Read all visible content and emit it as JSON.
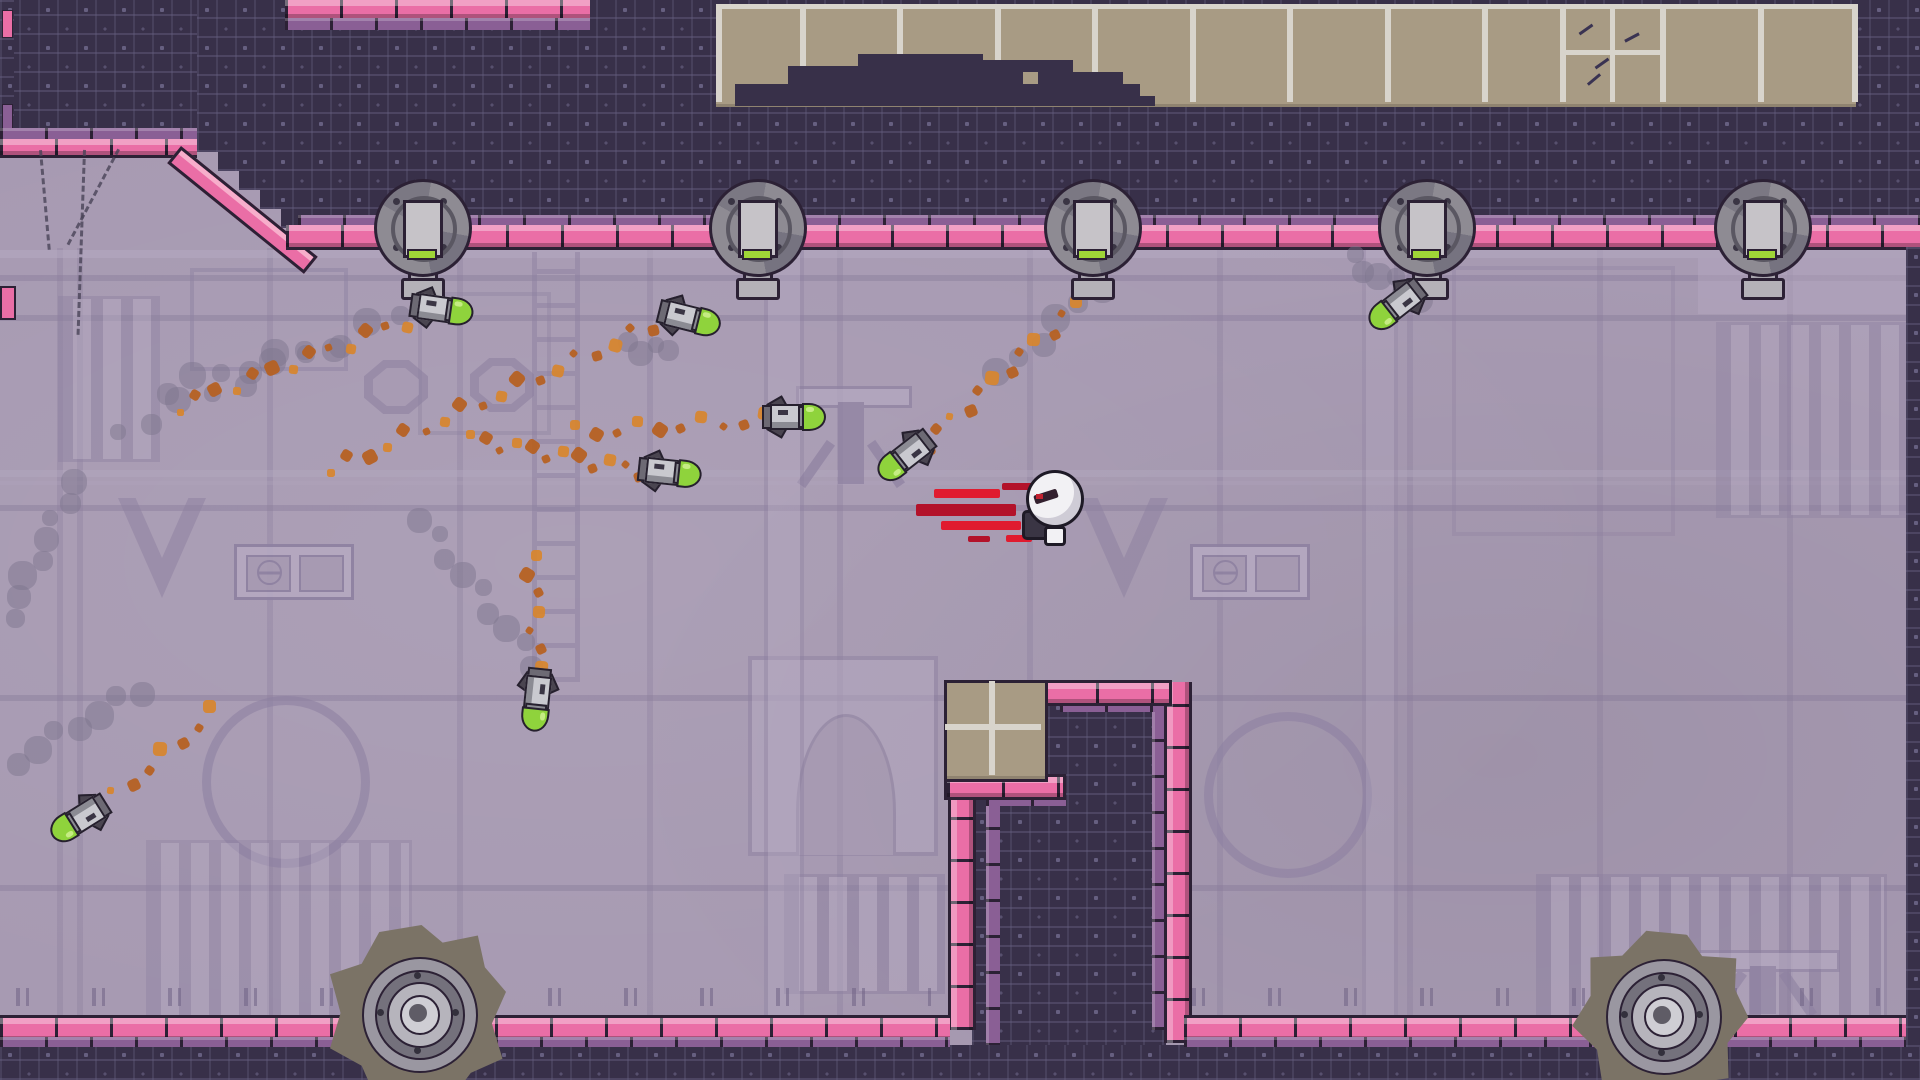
{
  "meta": {
    "scene_type": "pixel-platformer level",
    "visible_text": "none"
  },
  "palette": {
    "dark_tile": "#383049",
    "dark_outline": "#2c2135",
    "circuit_line": "#665f80",
    "wall_lavender": "#a79ab2",
    "wall_light": "#b5a9c1",
    "wall_shadow": "#8e81a1",
    "wall_line": "#7d7092",
    "brick_pink": "#ea6ea6",
    "brick_pink_highlight": "#f7aecb",
    "brick_purple_cap": "#8a5f95",
    "ceiling_tan": "#a89b84",
    "ceiling_divider": "#d8d4cc",
    "missile_green": "#8fd33c",
    "missile_steel": "#c9c9cf",
    "missile_steel_dark": "#8b8b93",
    "turret_gray": "#8e8b93",
    "turret_light": "#c6c3c8",
    "turret_green_light": "#9fd637",
    "gear_blade": "#7b7366",
    "gear_ring": "#9a97a1",
    "gear_core": "#cfced4",
    "trail_orange": "#b65f1e",
    "trail_orange_bright": "#d8862c",
    "smoke_gray": "#7d7590",
    "player_white": "#f2f1f4",
    "player_trail_red": "#e01b2f",
    "player_trail_red_dark": "#b3122a"
  },
  "scene": {
    "turrets": {
      "centers_x": [
        420,
        755,
        1090,
        1424,
        1760
      ],
      "center_y": 225
    },
    "missiles": [
      {
        "x": 440,
        "y": 307,
        "rot": 8
      },
      {
        "x": 688,
        "y": 316,
        "rot": 14
      },
      {
        "x": 792,
        "y": 415,
        "rot": 0
      },
      {
        "x": 908,
        "y": 457,
        "rot": 142
      },
      {
        "x": 668,
        "y": 470,
        "rot": 6
      },
      {
        "x": 539,
        "y": 698,
        "rot": 96
      },
      {
        "x": 82,
        "y": 820,
        "rot": 148
      },
      {
        "x": 1399,
        "y": 306,
        "rot": 142
      }
    ],
    "player": {
      "x": 1022,
      "y": 468
    },
    "red_streaks": [
      {
        "x": 934,
        "y": 489,
        "w": 66,
        "h": 9
      },
      {
        "x": 916,
        "y": 504,
        "w": 100,
        "h": 12
      },
      {
        "x": 941,
        "y": 521,
        "w": 80,
        "h": 9
      },
      {
        "x": 1002,
        "y": 483,
        "w": 34,
        "h": 7
      },
      {
        "x": 1006,
        "y": 535,
        "w": 26,
        "h": 7
      },
      {
        "x": 968,
        "y": 536,
        "w": 22,
        "h": 6
      }
    ],
    "gears": [
      {
        "x": 418,
        "y": 1013,
        "r": 88,
        "rot": 0
      },
      {
        "x": 1662,
        "y": 1015,
        "r": 84,
        "rot": 15
      }
    ],
    "trails": [
      {
        "t": "smoke",
        "x1": 118,
        "y1": 432,
        "x2": 432,
        "y2": 302,
        "n": 11
      },
      {
        "t": "smoke",
        "x1": 10,
        "y1": 616,
        "x2": 74,
        "y2": 482,
        "n": 8
      },
      {
        "t": "smoke",
        "x1": 166,
        "y1": 388,
        "x2": 332,
        "y2": 344,
        "n": 7
      },
      {
        "t": "smoke",
        "x1": 420,
        "y1": 520,
        "x2": 536,
        "y2": 664,
        "n": 9
      },
      {
        "t": "smoke",
        "x1": 1000,
        "y1": 376,
        "x2": 1118,
        "y2": 268,
        "n": 7
      },
      {
        "t": "smoke",
        "x1": 1352,
        "y1": 260,
        "x2": 1420,
        "y2": 298,
        "n": 6
      },
      {
        "t": "smoke",
        "x1": 628,
        "y1": 344,
        "x2": 668,
        "y2": 352,
        "n": 4
      },
      {
        "t": "smoke",
        "x1": 16,
        "y1": 760,
        "x2": 140,
        "y2": 690,
        "n": 7
      },
      {
        "t": "orange",
        "x1": 178,
        "y1": 406,
        "x2": 424,
        "y2": 314,
        "n": 14
      },
      {
        "t": "orange",
        "x1": 330,
        "y1": 470,
        "x2": 652,
        "y2": 326,
        "n": 18
      },
      {
        "t": "orange",
        "x1": 470,
        "y1": 438,
        "x2": 640,
        "y2": 470,
        "n": 12
      },
      {
        "t": "orange",
        "x1": 575,
        "y1": 432,
        "x2": 765,
        "y2": 420,
        "n": 10
      },
      {
        "t": "orange",
        "x1": 533,
        "y1": 556,
        "x2": 539,
        "y2": 686,
        "n": 8
      },
      {
        "t": "orange",
        "x1": 1078,
        "y1": 304,
        "x2": 924,
        "y2": 444,
        "n": 12
      },
      {
        "t": "orange",
        "x1": 214,
        "y1": 712,
        "x2": 98,
        "y2": 810,
        "n": 8
      },
      {
        "t": "orange",
        "x1": 1426,
        "y1": 270,
        "x2": 1402,
        "y2": 300,
        "n": 4
      }
    ],
    "chains": [
      {
        "x": 42,
        "y": 150,
        "len": 100,
        "rot": 85
      },
      {
        "x": 120,
        "y": 150,
        "len": 108,
        "rot": 118
      },
      {
        "x": 86,
        "y": 150,
        "len": 185,
        "rot": 92
      }
    ],
    "ceiling": {
      "dividers_x": [
        716,
        800,
        897,
        995,
        1092,
        1190,
        1287,
        1385,
        1482,
        1560,
        1660,
        1758,
        1852
      ],
      "quad_lines": [
        {
          "x": 1610,
          "y": 6,
          "w": 5,
          "h": 96
        },
        {
          "x": 1565,
          "y": 50,
          "w": 95,
          "h": 5
        }
      ],
      "scratches": [
        {
          "x": 1578,
          "y": 28,
          "r": -35
        },
        {
          "x": 1594,
          "y": 62,
          "r": -35
        },
        {
          "x": 1624,
          "y": 36,
          "r": -28
        },
        {
          "x": 1586,
          "y": 78,
          "r": -40
        }
      ],
      "mound_rects": [
        [
          735,
          84,
          405,
          18
        ],
        [
          788,
          66,
          235,
          20
        ],
        [
          858,
          54,
          125,
          14
        ],
        [
          958,
          60,
          115,
          12
        ],
        [
          1038,
          72,
          85,
          14
        ],
        [
          735,
          96,
          420,
          10
        ]
      ]
    },
    "wall_marks": [
      {
        "y": 10,
        "h": 26,
        "c": "#ea6ea6"
      },
      {
        "y": 104,
        "h": 26,
        "c": "#8a5f95"
      }
    ],
    "panels": [
      {
        "v": "light",
        "x": 0,
        "y": 250,
        "w": 1920,
        "h": 8,
        "o": 0.55
      },
      {
        "v": "light",
        "x": 0,
        "y": 470,
        "w": 1920,
        "h": 7,
        "o": 0.4
      },
      {
        "v": "light",
        "x": 0,
        "y": 481,
        "w": 1920,
        "h": 4,
        "o": 0.25
      },
      {
        "v": "dark",
        "x": 190,
        "y": 268,
        "w": 150,
        "h": 95,
        "o": 0.5
      },
      {
        "v": "dark",
        "x": 418,
        "y": 292,
        "w": 125,
        "h": 135,
        "o": 0.4
      },
      {
        "v": "slots",
        "x": 58,
        "y": 296,
        "w": 96,
        "h": 160,
        "o": 0.45
      },
      {
        "v": "dark",
        "x": 1452,
        "y": 266,
        "w": 215,
        "h": 262,
        "o": 0.35
      },
      {
        "v": "light",
        "x": 1698,
        "y": 258,
        "w": 222,
        "h": 56,
        "o": 0.45
      },
      {
        "v": "slots",
        "x": 1716,
        "y": 322,
        "w": 190,
        "h": 190,
        "o": 0.4
      },
      {
        "v": "octagon",
        "x": 364,
        "y": 360,
        "w": 64,
        "h": 54,
        "o": 0.6
      },
      {
        "v": "octagon",
        "x": 470,
        "y": 358,
        "w": 64,
        "h": 54,
        "o": 0.6
      },
      {
        "v": "chevron",
        "x": 118,
        "y": 498,
        "w": 88,
        "h": 100,
        "o": 0.55
      },
      {
        "v": "chevron",
        "x": 1080,
        "y": 498,
        "w": 88,
        "h": 100,
        "o": 0.55
      },
      {
        "v": "windows",
        "x": 234,
        "y": 544,
        "w": 114,
        "h": 50,
        "o": 0.9
      },
      {
        "v": "windows",
        "x": 1190,
        "y": 544,
        "w": 114,
        "h": 50,
        "o": 0.9
      },
      {
        "v": "circle",
        "x": 202,
        "y": 696,
        "w": 150,
        "h": 154,
        "o": 0.6
      },
      {
        "v": "circle",
        "x": 1204,
        "y": 712,
        "w": 150,
        "h": 148,
        "o": 0.6
      },
      {
        "v": "slots",
        "x": 146,
        "y": 840,
        "w": 260,
        "h": 172,
        "o": 0.4
      },
      {
        "v": "slots",
        "x": 1536,
        "y": 874,
        "w": 345,
        "h": 138,
        "o": 0.5
      },
      {
        "v": "slots",
        "x": 784,
        "y": 874,
        "w": 155,
        "h": 114,
        "o": 0.5
      },
      {
        "v": "arch",
        "x": 748,
        "y": 656,
        "w": 182,
        "h": 192,
        "o": 0.5
      },
      {
        "v": "pedestal",
        "x": 796,
        "y": 386,
        "w": 110,
        "h": 98,
        "o": 0.7
      },
      {
        "v": "pedestal",
        "x": 1692,
        "y": 950,
        "w": 142,
        "h": 64,
        "o": 0.6
      },
      {
        "v": "ladder",
        "x": 532,
        "y": 252,
        "w": 38,
        "h": 430,
        "o": 0.5
      },
      {
        "v": "pillar",
        "x": 764,
        "y": 250,
        "w": 32,
        "h": 766,
        "o": 0.4
      },
      {
        "v": "pillar",
        "x": 1362,
        "y": 250,
        "w": 28,
        "h": 766,
        "o": 0.3
      }
    ]
  }
}
